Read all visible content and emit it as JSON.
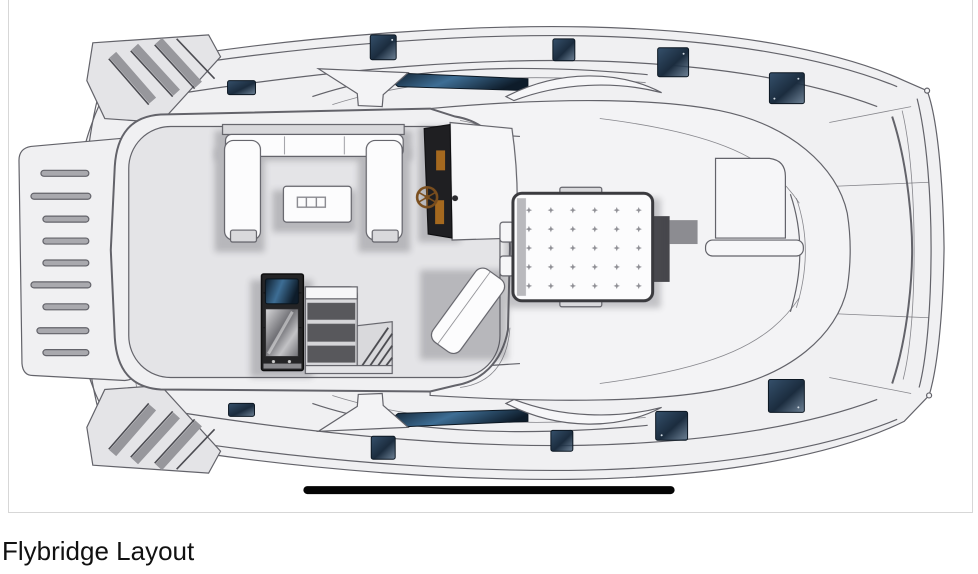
{
  "caption": "Flybridge Layout",
  "figure": {
    "type": "boat-deck-plan-diagram",
    "view": "top-down line drawing of a power catamaran flybridge, bow to the right",
    "features": [
      "hull-outline",
      "bow",
      "stern-boarding-steps",
      "aft-wing-steps",
      "flybridge-deck",
      "u-shaped-settee",
      "coffee-table",
      "helm-console",
      "steering-wheel",
      "helm-bench-seat",
      "wet-bar-fridge",
      "bar-counter-shelves",
      "staircase-to-cockpit",
      "tufted-sunpad",
      "foredeck-lockers",
      "foredeck-crossbar",
      "windshield-glass",
      "deck-hatches",
      "scale-bar"
    ],
    "deck_hatches_count": 10,
    "sunpad_tufts": {
      "rows": 5,
      "cols": 6
    }
  },
  "diagram": {
    "colors": {
      "line": "#63636a",
      "hull": "#f0f0f2",
      "deck": "#e4e4e7",
      "coachroof": "#f3f3f5",
      "cushion": "#fcfcfd",
      "hatch-navy": "#1b2c3e",
      "hatch-navy-light": "#35506b",
      "glass-hi": "#3e6e95",
      "glass-dark": "#0e1c2a",
      "bar-dark": "#242426",
      "metal-light": "#d9d9db",
      "metal-dark": "#6f6f74",
      "wheel-brown": "#7a4e1e",
      "instrument-orange": "#a5691f",
      "scale-bar": "#050505",
      "caption-color": "#111111",
      "frame-border": "#d7d7d7"
    }
  }
}
